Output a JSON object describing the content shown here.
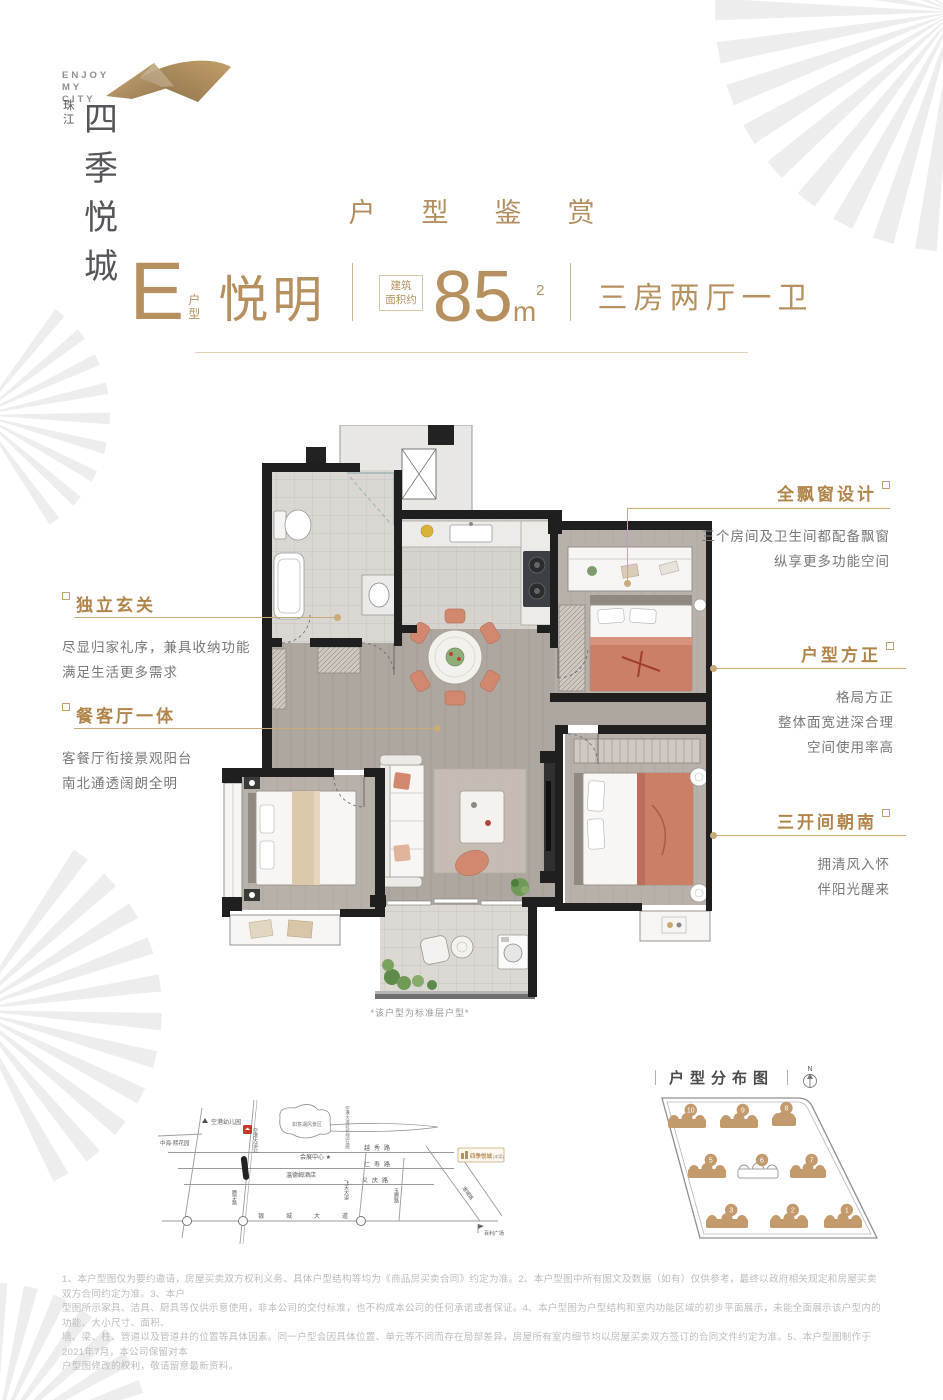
{
  "brand": {
    "tagline1": "ENJOY",
    "tagline2": "MY CITY",
    "name_small": "珠江",
    "name_main": "四季悦城"
  },
  "page_title": "户型鉴赏",
  "unit": {
    "type_letter": "E",
    "type_label": "户型",
    "name": "悦明",
    "area_label1": "建筑",
    "area_label2": "面积约",
    "area_value": "85",
    "area_unit": "m",
    "area_exp": "2",
    "rooms": "三房两厅一卫"
  },
  "callouts": {
    "bay": {
      "title": "全飘窗设计",
      "lines": [
        "三个房间及卫生间都配备飘窗",
        "纵享更多功能空间"
      ]
    },
    "foyer": {
      "title": "独立玄关",
      "lines": [
        "尽显归家礼序，兼具收纳功能",
        "满足生活更多需求"
      ]
    },
    "dining": {
      "title": "餐客厅一体",
      "lines": [
        "客餐厅衔接景观阳台",
        "南北通透阔朗全明"
      ]
    },
    "square": {
      "title": "户型方正",
      "lines": [
        "格局方正",
        "整体面宽进深合理",
        "空间使用率高"
      ]
    },
    "south": {
      "title": "三开间朝南",
      "lines": [
        "拥清风入怀",
        "伴阳光醒来"
      ]
    }
  },
  "floorplan_note": "*该户型为标准层户型*",
  "map": {
    "labels": {
      "kindergarten": "空港幼儿园",
      "zhonghai": "中海·熙花园",
      "lake": "如意湖风景区",
      "exhibition": "会展中心 ★",
      "hotel": "温德姆酒店",
      "station": "空港大道北",
      "extension": "空港大道延长线(在建)",
      "yuexiu": "越秀路",
      "renshou": "仁寿路",
      "yiqing": "义庆路",
      "tengyu": "腾宇路",
      "feitian": "飞天大道",
      "yuteng": "玉腾路",
      "gangcheng": "港城路",
      "yincheng": "银城大道",
      "baili": "百利广场",
      "project": "四季悦城",
      "project_tag": "(本案)"
    }
  },
  "distribution": {
    "title": "户型分布图",
    "compass": "N",
    "buildings": [
      {
        "num": "10",
        "filled": true
      },
      {
        "num": "9",
        "filled": true
      },
      {
        "num": "8",
        "filled": true
      },
      {
        "num": "5",
        "filled": true
      },
      {
        "num": "6",
        "filled": false
      },
      {
        "num": "7",
        "filled": true
      },
      {
        "num": "3",
        "filled": true
      },
      {
        "num": "2",
        "filled": true
      },
      {
        "num": "1",
        "filled": true
      }
    ]
  },
  "disclaimer": {
    "lines": [
      "1、本户型图仅为要约邀请，房屋买卖双方权利义务、具体户型结构等均为《商品房买卖合同》约定为准。2、本户型图中所有图文及数据（如有）仅供参考，最终以政府相关规定和房屋买卖双方合同约定为准。3、本户",
      "型图所示家具、洁具、厨具等仅供示意使用，非本公司的交付标准，也不构成本公司的任何承诺或者保证。4、本户型图为户型结构和室内功能区域的初步平面展示，未能全面展示该户型内的功能、大小尺寸、面积、",
      "墙、梁、柱、管道以及管道井的位置等具体因素。同一户型会因具体位置、单元等不同而存在局部差异，房屋所有室内细节均以房屋买卖双方签订的合同文件约定为准。5、本户型图制作于2021年7月，本公司保留对本",
      "户型图修改的权利，敬请留意最新资料。"
    ]
  },
  "colors": {
    "gold": "#b6915f",
    "gold_line": "#c9ab79",
    "text_gray": "#777777",
    "light_gray": "#bcbcbc"
  }
}
